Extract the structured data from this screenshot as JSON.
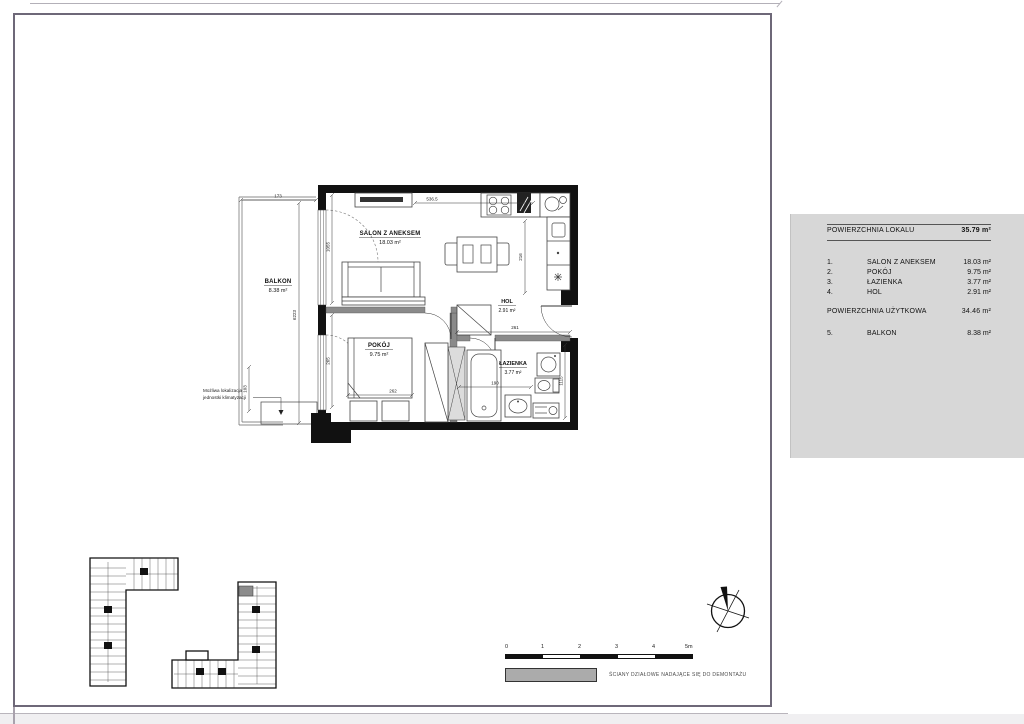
{
  "floor_plan": {
    "rooms": [
      {
        "name": "BALKON",
        "area": "8.38 m²"
      },
      {
        "name": "SALON Z ANEKSEM",
        "area": "18.03 m²"
      },
      {
        "name": "POKÓJ",
        "area": "9.75 m²"
      },
      {
        "name": "HOL",
        "area": "2.91 m²"
      },
      {
        "name": "ŁAZIENKA",
        "area": "3.77 m²"
      }
    ],
    "dimensions": {
      "balcony_width": "173",
      "salon_width": "536.5",
      "balcony_length": "6223",
      "salon_window": "1055",
      "room_window": "265",
      "balcony_bottom": "103",
      "kitchen": "216",
      "hol_width": "261",
      "bath_width": "190",
      "bath_height": "1115",
      "bed_width": "262"
    },
    "annotation_line1": "Możliwa lokalizacja",
    "annotation_line2": "jednostki klimatyzacji"
  },
  "legend_panel": {
    "title": "POWIERZCHNIA LOKALU",
    "total": "35.79 m²",
    "rows": [
      {
        "no": "1.",
        "name": "SALON Z ANEKSEM",
        "area": "18.03 m²"
      },
      {
        "no": "2.",
        "name": "POKÓJ",
        "area": "9.75 m²"
      },
      {
        "no": "3.",
        "name": "ŁAZIENKA",
        "area": "3.77 m²"
      },
      {
        "no": "4.",
        "name": "HOL",
        "area": "2.91 m²"
      }
    ],
    "subtotal_label": "POWIERZCHNIA UŻYTKOWA",
    "subtotal": "34.46 m²",
    "extra_row": {
      "no": "5.",
      "name": "BALKON",
      "area": "8.38 m²"
    }
  },
  "scale_bar": {
    "labels": [
      "0",
      "1",
      "2",
      "3",
      "4",
      "5m"
    ]
  },
  "wall_legend": {
    "label": "ŚCIANY DZIAŁOWE NADAJĄCE SIĘ DO DEMONTAŻU"
  },
  "colors": {
    "panel_bg": "#d7d7d7",
    "highlight": "#8c8c8c",
    "swatch": "#ababab",
    "frame": "#6e6878"
  }
}
